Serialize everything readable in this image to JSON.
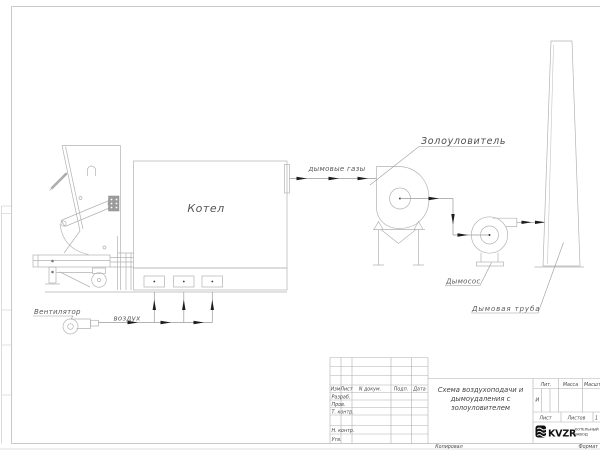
{
  "schematic": {
    "boiler_label": "Котел",
    "flue_gases_label": "дымовые газы",
    "ash_catcher_label": "Золоуловитель",
    "smoke_exhauster_label": "Дымосос",
    "chimney_label": "Дымовая труба",
    "fan_label": "Вентилятор",
    "air_label": "воздух"
  },
  "title_block": {
    "revision_header": [
      "Изм",
      "Лист",
      "N докум.",
      "Подп.",
      "Дата"
    ],
    "signature_rows": [
      "Разраб.",
      "Пров.",
      "Т. контр.",
      "Н. контр.",
      "Утв."
    ],
    "doc_title_line1": "Схема воздухоподачи и",
    "doc_title_line2": "дымоудаления с",
    "doc_title_line3": "золоуловителем",
    "lit_label": "Лит.",
    "lit_value": "И",
    "mass_label": "Масса",
    "scale_label": "Масштаб",
    "sheet_label": "Лист",
    "sheets_label": "Листов",
    "sheets_value": "1",
    "brand_name": "KVZR",
    "brand_line1": "КОТЕЛЬНЫЙ",
    "brand_line2": "ЗАВОД",
    "copied_label": "Копировал",
    "format_label": "Формат"
  },
  "colors": {
    "drawing_line": "#b3b3b3",
    "flow_line": "#9a9a9a",
    "label_text": "#5a5a5a",
    "arrowhead": "#1c1c1c",
    "brand_black": "#101010"
  }
}
